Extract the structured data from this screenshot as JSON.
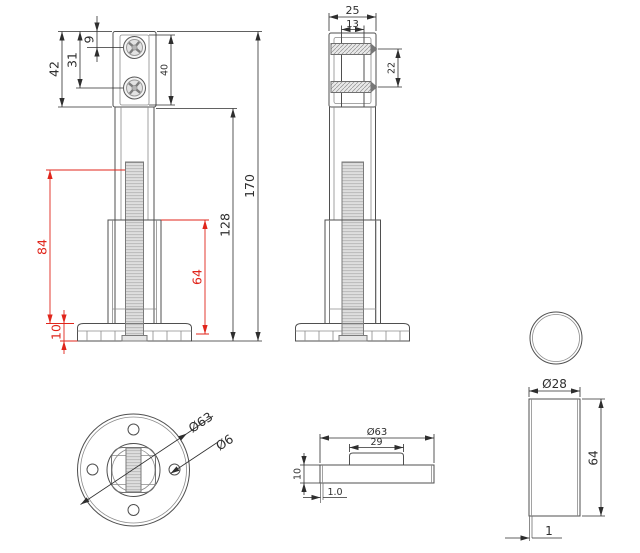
{
  "title": "Adjustable levelling foot technical drawing",
  "colors": {
    "background": "#ffffff",
    "line": "#4f4f4f",
    "dimension": "#2e2e2e",
    "highlight_red": "#e0251b"
  },
  "views": {
    "front": {
      "label": "front-view",
      "dimensions": {
        "bracket_height": "42",
        "hole2_offset": "31",
        "hole1_offset": "9",
        "plate_height": "40",
        "total_height": "170",
        "shaft_height": "128",
        "thread_length": "84",
        "sleeve_length": "64",
        "base_height": "10"
      }
    },
    "side": {
      "label": "side-view",
      "dimensions": {
        "bracket_depth": "25",
        "channel_width": "13",
        "hole_spacing": "22"
      }
    },
    "bottom": {
      "label": "bottom-view",
      "dimensions": {
        "base_diameter": "Ø63",
        "hole_diameter": "Ø6"
      }
    },
    "base_profile": {
      "label": "base-side-view",
      "dimensions": {
        "diameter": "Ø63",
        "boss_width": "29",
        "height": "10",
        "wall_thickness": "1.0"
      }
    },
    "tube": {
      "label": "tube-detail-view",
      "dimensions": {
        "diameter": "Ø28",
        "length": "64",
        "wall_thickness": "1"
      }
    }
  }
}
